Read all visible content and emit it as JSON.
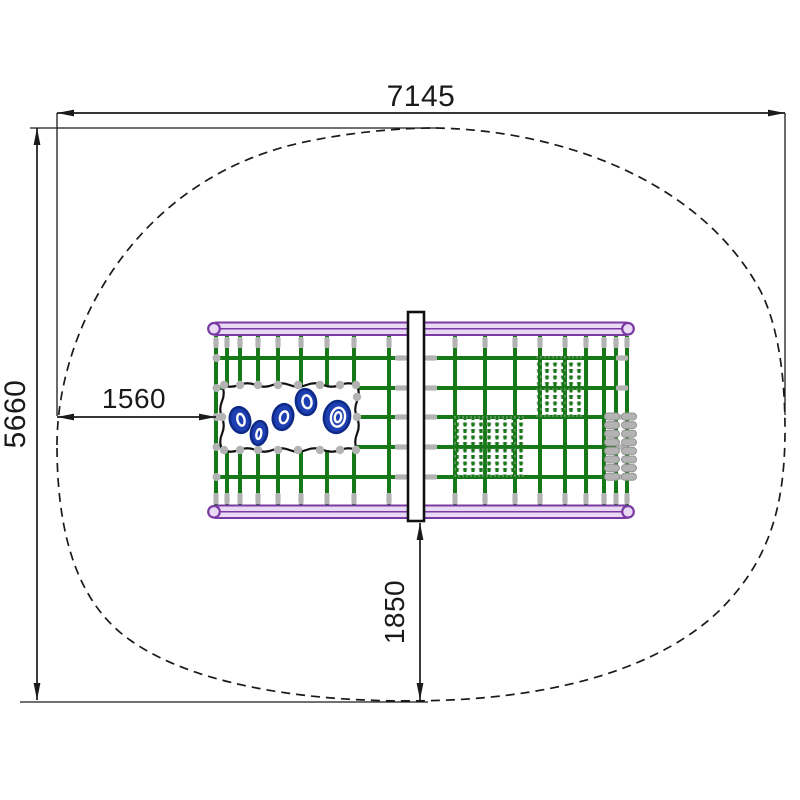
{
  "diagram": {
    "type": "playground-equipment-plan-view",
    "dimensions": {
      "total_width": "7145",
      "total_depth": "5660",
      "structure_left_offset": "1560",
      "structure_bottom_offset": "1850"
    },
    "colors": {
      "background": "#ffffff",
      "line": "#1a1a1a",
      "rope": "#177817",
      "rail": "#7a3aa3",
      "rail_fill": "#e9d9f4",
      "connector": "#b3b3b3",
      "post_fill": "#ffffff",
      "hold_fill": "#1d3fb2",
      "hold_outline": "#0e2a86",
      "hold_inner": "#ffffff"
    }
  }
}
